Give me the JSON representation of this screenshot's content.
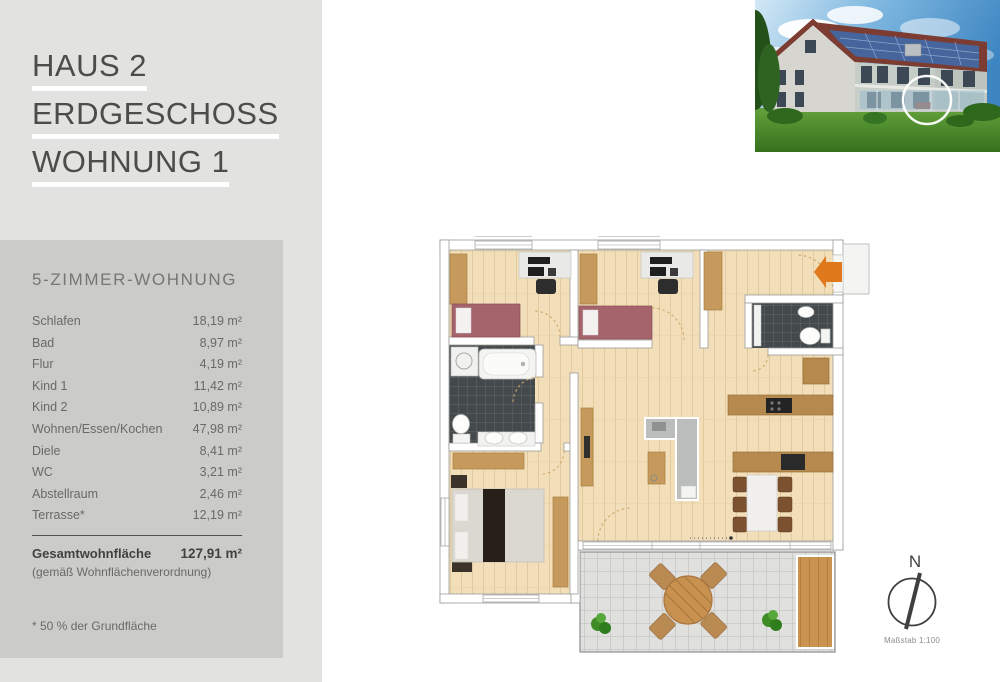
{
  "sidebar": {
    "title_lines": [
      "HAUS 2",
      "ERDGESCHOSS",
      "WOHNUNG 1"
    ],
    "subtitle": "5-ZIMMER-WOHNUNG",
    "rooms": [
      {
        "label": "Schlafen",
        "area": "18,19 m²"
      },
      {
        "label": "Bad",
        "area": "8,97 m²"
      },
      {
        "label": "Flur",
        "area": "4,19 m²"
      },
      {
        "label": "Kind 1",
        "area": "11,42 m²"
      },
      {
        "label": "Kind 2",
        "area": "10,89 m²"
      },
      {
        "label": "Wohnen/Essen/Kochen",
        "area": "47,98 m²"
      },
      {
        "label": "Diele",
        "area": "8,41 m²"
      },
      {
        "label": "WC",
        "area": "3,21 m²"
      },
      {
        "label": "Abstellraum",
        "area": "2,46 m²"
      },
      {
        "label": "Terrasse*",
        "area": "12,19 m²"
      }
    ],
    "total": {
      "label": "Gesamtwohnfläche",
      "area": "127,91 m²",
      "note": "(gemäß Wohnflächenverordnung)"
    },
    "footnote": "* 50 % der Grundfläche"
  },
  "plan": {
    "compass_letter": "N",
    "scale_label": "Maßstab 1:100"
  },
  "colors": {
    "panel_light": "#e2e2e1",
    "panel_dark": "#cbcbca",
    "title_text": "#4c4c4a",
    "entry_arrow": "#e0791c",
    "wood_floor": "#f2dfba",
    "dark_tile": "#44494c",
    "kids_bed": "#a5636c"
  }
}
